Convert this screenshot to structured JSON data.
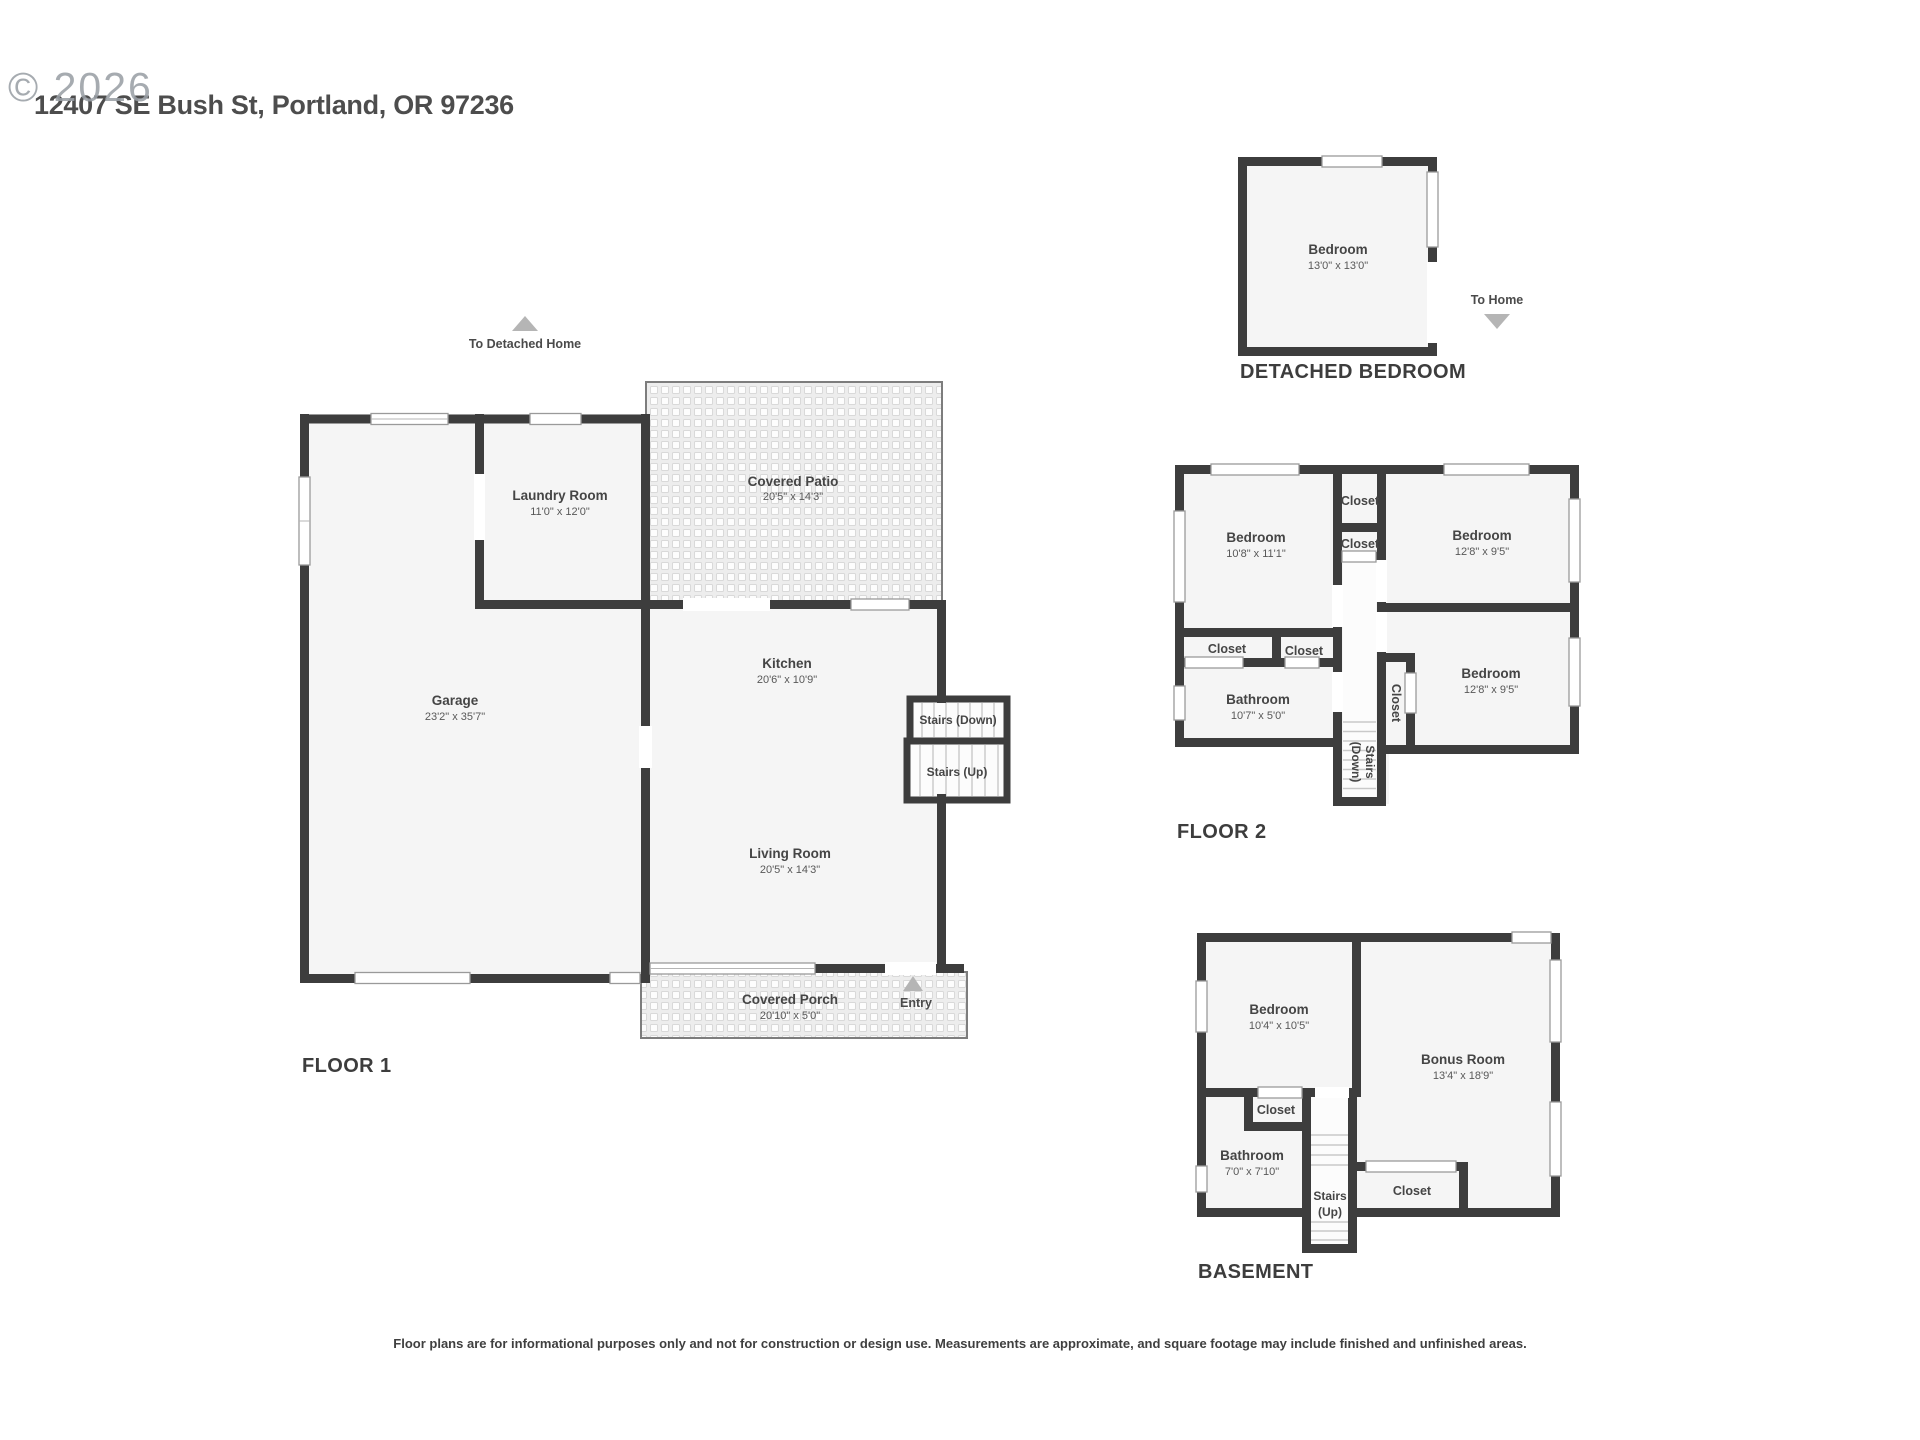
{
  "header": {
    "watermark": "© 2026",
    "address": "12407 SE Bush St, Portland, OR 97236"
  },
  "colors": {
    "wall": "#3d3d3d",
    "room_fill": "#f5f5f5",
    "hatch_base": "#ededed",
    "arrow": "#b5b5b5",
    "watermark_gray": "#9aa0a6"
  },
  "floor1": {
    "title": "FLOOR 1",
    "to_detached_home": "To Detached Home",
    "entry_label": "Entry",
    "stairs_down": "Stairs (Down)",
    "stairs_up": "Stairs (Up)",
    "rooms": {
      "garage": {
        "name": "Garage",
        "dims": "23'2\" x 35'7\""
      },
      "laundry": {
        "name": "Laundry Room",
        "dims": "11'0\" x 12'0\""
      },
      "patio": {
        "name": "Covered Patio",
        "dims": "20'5\" x 14'3\""
      },
      "kitchen": {
        "name": "Kitchen",
        "dims": "20'6\" x 10'9\""
      },
      "living": {
        "name": "Living Room",
        "dims": "20'5\" x 14'3\""
      },
      "porch": {
        "name": "Covered Porch",
        "dims": "20'10\" x 5'0\""
      }
    }
  },
  "detached": {
    "title": "DETACHED BEDROOM",
    "to_home": "To Home",
    "bedroom": {
      "name": "Bedroom",
      "dims": "13'0\" x 13'0\""
    }
  },
  "floor2": {
    "title": "FLOOR 2",
    "closet": "Closet",
    "stairs_line1": "Stairs",
    "stairs_line2": "(Down)",
    "rooms": {
      "bedroom1": {
        "name": "Bedroom",
        "dims": "10'8\" x 11'1\""
      },
      "bedroom2": {
        "name": "Bedroom",
        "dims": "12'8\" x 9'5\""
      },
      "bedroom3": {
        "name": "Bedroom",
        "dims": "12'8\" x 9'5\""
      },
      "bathroom": {
        "name": "Bathroom",
        "dims": "10'7\" x 5'0\""
      }
    }
  },
  "basement": {
    "title": "BASEMENT",
    "closet": "Closet",
    "stairs_line1": "Stairs",
    "stairs_line2": "(Up)",
    "rooms": {
      "bedroom": {
        "name": "Bedroom",
        "dims": "10'4\" x 10'5\""
      },
      "bonus": {
        "name": "Bonus Room",
        "dims": "13'4\" x 18'9\""
      },
      "bathroom": {
        "name": "Bathroom",
        "dims": "7'0\" x 7'10\""
      }
    }
  },
  "footer": {
    "disclaimer": "Floor plans are for informational purposes only and not for construction or design use. Measurements are approximate, and square footage may include finished and unfinished areas."
  }
}
